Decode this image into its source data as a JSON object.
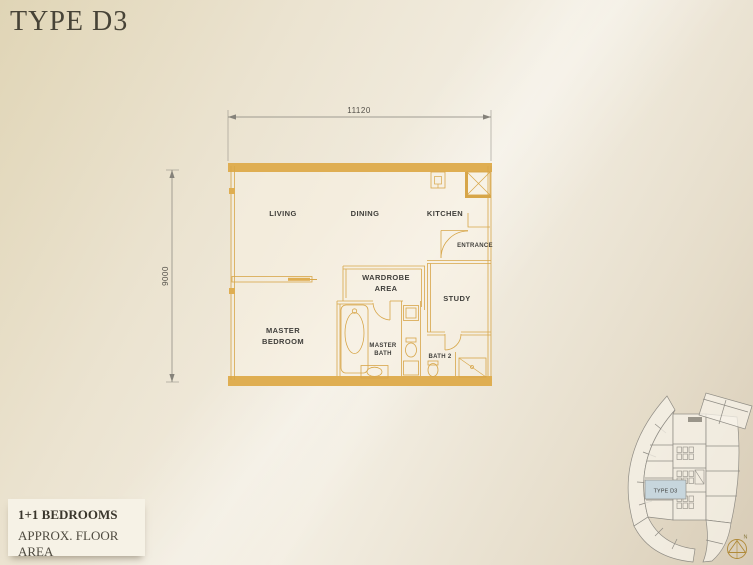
{
  "title": "TYPE D3",
  "info_card": {
    "bedrooms": "1+1 BEDROOMS",
    "area_label": "APPROX. FLOOR AREA",
    "area_value": "1, 076 sq.ft. / 100 sq.m."
  },
  "floor_plan": {
    "dim_width": "11120",
    "dim_height": "9000",
    "rooms": {
      "living": "LIVING",
      "dining": "DINING",
      "kitchen": "KITCHEN",
      "entrance": "ENTRANCE",
      "wardrobe_line1": "WARDROBE",
      "wardrobe_line2": "AREA",
      "study": "STUDY",
      "master_bedroom_line1": "MASTER",
      "master_bedroom_line2": "BEDROOM",
      "master_bath_line1": "MASTER",
      "master_bath_line2": "BATH",
      "bath2": "BATH 2"
    }
  },
  "key_plan": {
    "unit_label": "TYPE D3",
    "compass_label": "N"
  },
  "colors": {
    "wall_gold": "#dfae52",
    "line_gold": "#d7a649",
    "unit_highlight": "#c7d6dd",
    "keyplan_line": "#8f8c84"
  }
}
